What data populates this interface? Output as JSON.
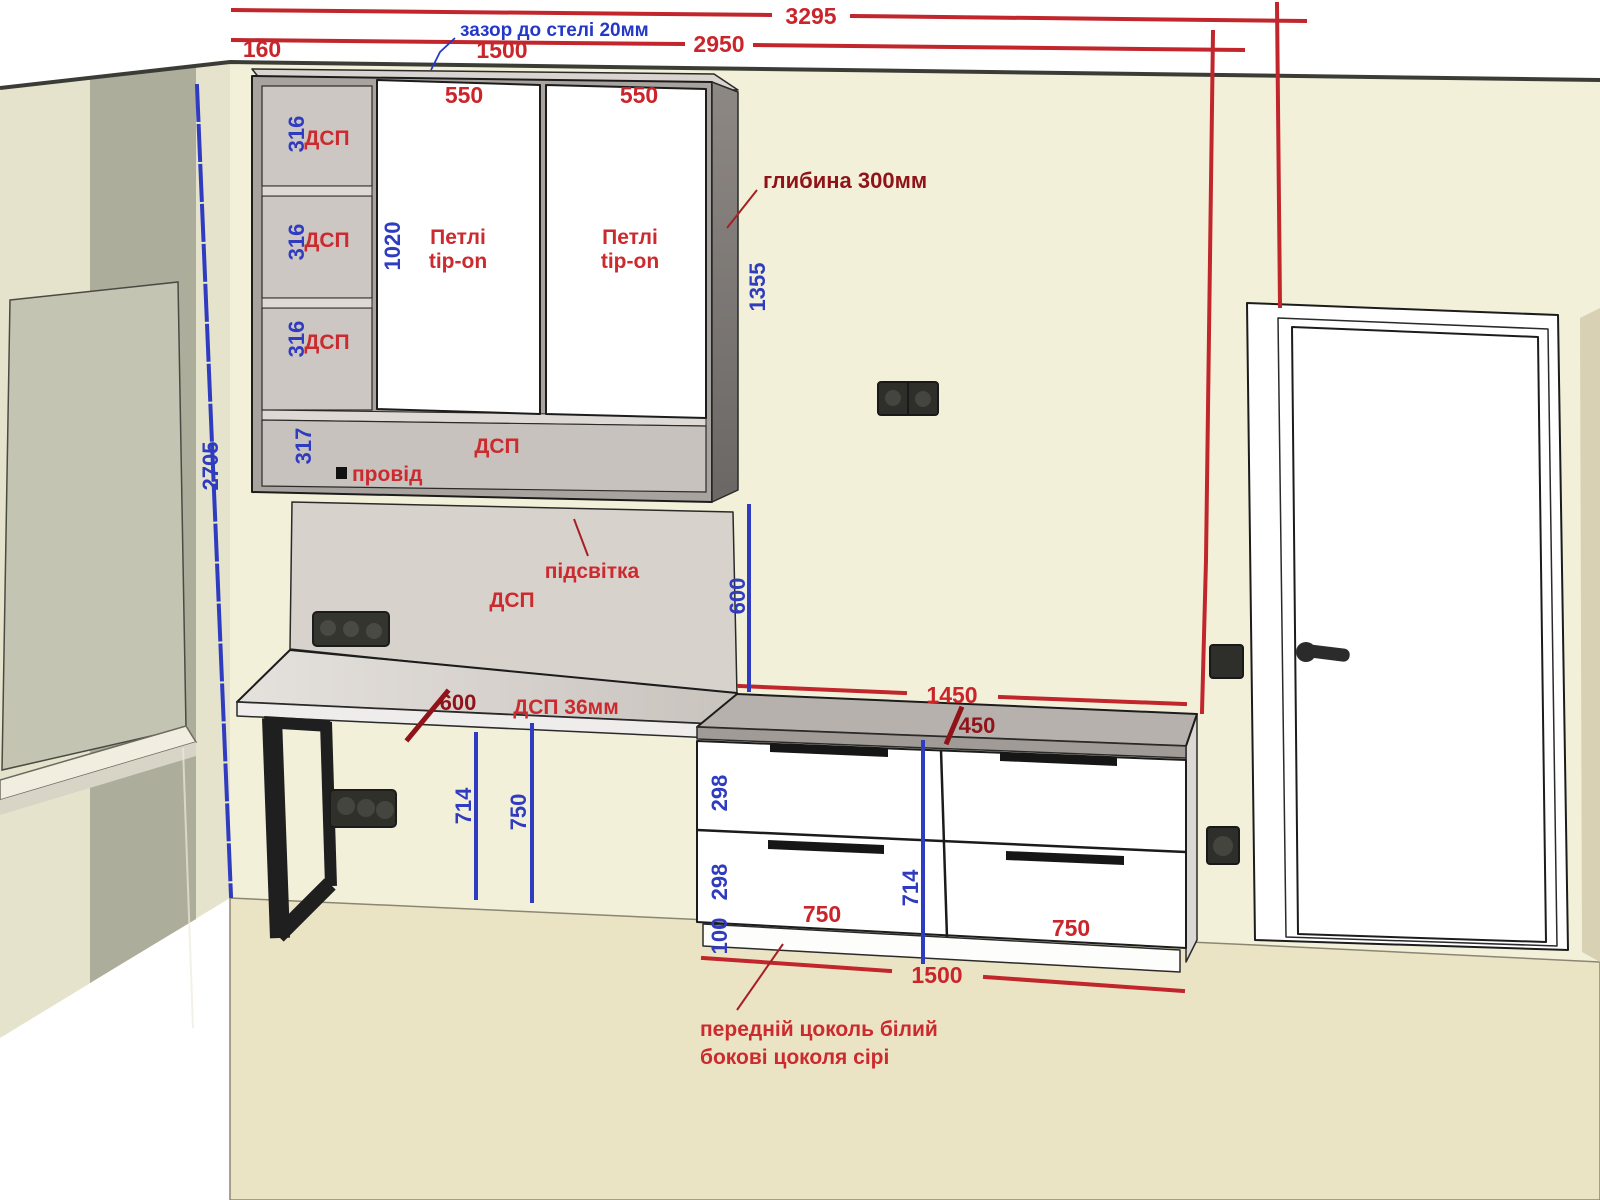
{
  "drawing": {
    "type": "furniture-elevation-3d",
    "language": "uk"
  },
  "colors": {
    "dim_red": "#c9252b",
    "dim_red_dark": "#8f1318",
    "dim_blue": "#2f3cc0",
    "back_wall": "#f3f0da",
    "side_wall_band": "#adad9b",
    "side_wall_light": "#e6e3cc",
    "floor": "#ebe4c4",
    "cabinet_carcass": "#a9a39f",
    "cabinet_interior": "#cdc7c3",
    "cabinet_side": "#847f7b",
    "panel": "#d8d2cc",
    "countertop": "#b7b1ad",
    "front_white": "#ffffff",
    "metal_black": "#1f1f1f"
  },
  "notes": {
    "gap_ceiling": "зазор до стелі 20мм",
    "depth": "глибина 300мм",
    "hinge_line1": "Петлі",
    "hinge_line2": "tip-on",
    "dsp": "ДСП",
    "wire": "провід",
    "backlight": "підсвітка",
    "desktop_material": "ДСП 36мм",
    "plinth_line1": "передній цоколь білий",
    "plinth_line2": "бокові цоколя сірі"
  },
  "dims": {
    "d3295": "3295",
    "d2950": "2950",
    "d160": "160",
    "d1500_top": "1500",
    "d550": "550",
    "d1450": "1450",
    "d450": "450",
    "d600_desk": "600",
    "d750_drawer": "750",
    "d1500_bottom": "1500",
    "d2705": "2705",
    "d316": "316",
    "d317": "317",
    "d1020": "1020",
    "d1355": "1355",
    "d600_panel": "600",
    "d714_desk": "714",
    "d750_desk": "750",
    "d298": "298",
    "d100": "100",
    "d714_unit": "714"
  }
}
